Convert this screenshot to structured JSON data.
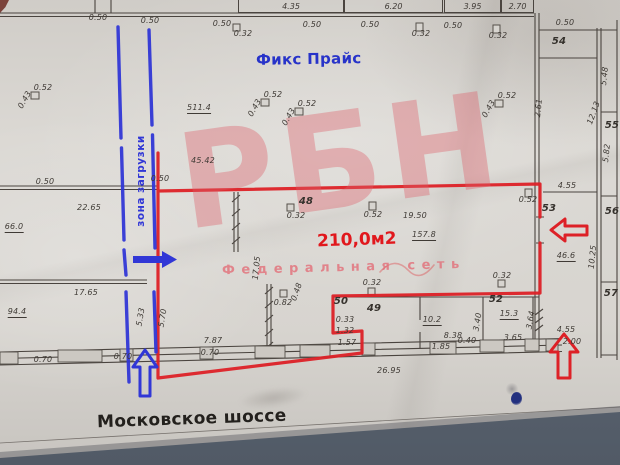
{
  "labels": {
    "store_name": "Фикс Прайс",
    "street_name": "Московское шоссе",
    "premises_area": "210,0м2",
    "loading_zone": "зона загрузки"
  },
  "watermark": {
    "text": "РБН",
    "subtitle": "Федеральная сеть"
  },
  "colors": {
    "annotation_red": "#dd2127",
    "annotation_blue": "#3137d6",
    "store_name_blue": "#2733c9",
    "watermark_pink": "#e57b86",
    "paper_grey": "#d8d5d0",
    "table_grey_blue": "#5a6370",
    "ink_black": "#46403a"
  },
  "top_dimension_boxes": [
    "4.35",
    "6.20",
    "3.95",
    "2.70"
  ],
  "dimensions": [
    {
      "t": "0.50",
      "x": 98,
      "y": 18
    },
    {
      "t": "0.50",
      "x": 150,
      "y": 21
    },
    {
      "t": "0.50",
      "x": 222,
      "y": 24
    },
    {
      "t": "0.32",
      "x": 243,
      "y": 34
    },
    {
      "t": "0.50",
      "x": 312,
      "y": 25
    },
    {
      "t": "0.50",
      "x": 370,
      "y": 25
    },
    {
      "t": "0.32",
      "x": 421,
      "y": 34
    },
    {
      "t": "0.50",
      "x": 453,
      "y": 26
    },
    {
      "t": "0.32",
      "x": 498,
      "y": 36
    },
    {
      "t": "0.50",
      "x": 565,
      "y": 23
    },
    {
      "t": "0.52",
      "x": 43,
      "y": 88
    },
    {
      "t": "0.43",
      "x": 25,
      "y": 100,
      "r": -60
    },
    {
      "t": "511.4",
      "x": 199,
      "y": 109,
      "u": 1
    },
    {
      "t": "0.52",
      "x": 273,
      "y": 95
    },
    {
      "t": "0.43",
      "x": 255,
      "y": 108,
      "r": -60
    },
    {
      "t": "0.52",
      "x": 307,
      "y": 104
    },
    {
      "t": "0.43",
      "x": 289,
      "y": 117,
      "r": -60
    },
    {
      "t": "0.52",
      "x": 507,
      "y": 96
    },
    {
      "t": "0.43",
      "x": 489,
      "y": 109,
      "r": -60
    },
    {
      "t": "45.42",
      "x": 203,
      "y": 161
    },
    {
      "t": "0.50",
      "x": 45,
      "y": 182
    },
    {
      "t": "0.50",
      "x": 160,
      "y": 179
    },
    {
      "t": "22.65",
      "x": 89,
      "y": 208
    },
    {
      "t": "66.0",
      "x": 14,
      "y": 228,
      "u": 1
    },
    {
      "t": "17.65",
      "x": 86,
      "y": 293
    },
    {
      "t": "94.4",
      "x": 17,
      "y": 313,
      "u": 1
    },
    {
      "t": "48",
      "x": 306,
      "y": 202,
      "c": "room"
    },
    {
      "t": "0.32",
      "x": 296,
      "y": 216
    },
    {
      "t": "0.52",
      "x": 373,
      "y": 215
    },
    {
      "t": "0.52",
      "x": 528,
      "y": 200
    },
    {
      "t": "19.50",
      "x": 415,
      "y": 216
    },
    {
      "t": "157.8",
      "x": 424,
      "y": 236,
      "u": 1
    },
    {
      "t": "17.05",
      "x": 257,
      "y": 268,
      "r": -84
    },
    {
      "t": "0.82",
      "x": 283,
      "y": 303
    },
    {
      "t": "0.48",
      "x": 297,
      "y": 292,
      "r": -70
    },
    {
      "t": "0.32",
      "x": 372,
      "y": 283
    },
    {
      "t": "0.32",
      "x": 502,
      "y": 276
    },
    {
      "t": "50",
      "x": 341,
      "y": 302,
      "c": "room"
    },
    {
      "t": "49",
      "x": 374,
      "y": 309,
      "c": "room"
    },
    {
      "t": "0.33",
      "x": 345,
      "y": 320
    },
    {
      "t": "1.32",
      "x": 345,
      "y": 331
    },
    {
      "t": "1.57",
      "x": 347,
      "y": 343
    },
    {
      "t": "10.2",
      "x": 432,
      "y": 321,
      "u": 1
    },
    {
      "t": "8.38",
      "x": 453,
      "y": 336
    },
    {
      "t": "1.85",
      "x": 441,
      "y": 347
    },
    {
      "t": "0.40",
      "x": 467,
      "y": 341
    },
    {
      "t": "52",
      "x": 496,
      "y": 300,
      "c": "room"
    },
    {
      "t": "15.3",
      "x": 509,
      "y": 315,
      "u": 1
    },
    {
      "t": "3.65",
      "x": 513,
      "y": 338
    },
    {
      "t": "3.40",
      "x": 478,
      "y": 322,
      "r": -80
    },
    {
      "t": "3.64",
      "x": 531,
      "y": 320,
      "r": -80
    },
    {
      "t": "5.33",
      "x": 141,
      "y": 317,
      "r": -80
    },
    {
      "t": "5.70",
      "x": 163,
      "y": 318,
      "r": -80
    },
    {
      "t": "7.87",
      "x": 213,
      "y": 341
    },
    {
      "t": "0.70",
      "x": 210,
      "y": 353
    },
    {
      "t": "0.70",
      "x": 43,
      "y": 360
    },
    {
      "t": "0.70",
      "x": 123,
      "y": 357
    },
    {
      "t": "26.95",
      "x": 389,
      "y": 371
    },
    {
      "t": "4.55",
      "x": 566,
      "y": 330
    },
    {
      "t": "2.00",
      "x": 572,
      "y": 342
    },
    {
      "t": "53",
      "x": 549,
      "y": 209,
      "c": "room"
    },
    {
      "t": "4.55",
      "x": 567,
      "y": 186
    },
    {
      "t": "46.6",
      "x": 566,
      "y": 257,
      "u": 1
    },
    {
      "t": "10.25",
      "x": 593,
      "y": 257,
      "r": -84
    },
    {
      "t": "12.13",
      "x": 594,
      "y": 113,
      "r": -70
    },
    {
      "t": "5.48",
      "x": 605,
      "y": 76,
      "r": -84
    },
    {
      "t": "5.82",
      "x": 607,
      "y": 153,
      "r": -84
    },
    {
      "t": "2.61",
      "x": 539,
      "y": 108,
      "r": -84
    },
    {
      "t": "54",
      "x": 559,
      "y": 42,
      "c": "room"
    },
    {
      "t": "55",
      "x": 612,
      "y": 126,
      "c": "room"
    },
    {
      "t": "56",
      "x": 612,
      "y": 212,
      "c": "room"
    },
    {
      "t": "57",
      "x": 611,
      "y": 294,
      "c": "room"
    }
  ]
}
